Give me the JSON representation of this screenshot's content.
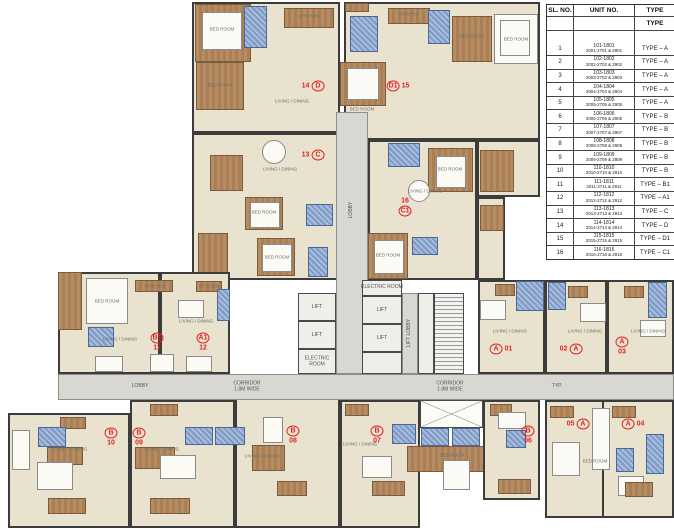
{
  "colors": {
    "wall": "#3c3c3c",
    "room_beige": "#e9e2cf",
    "wood_brown": "#b08158",
    "bath_blue": "#7d9ac7",
    "corridor_gray": "#d9d7d2",
    "unit_label_red": "#e02424"
  },
  "table": {
    "headers": {
      "sl": "SL. NO.",
      "unit": "UNIT NO.",
      "type": "TYPE"
    },
    "subheader_type": "TYPE",
    "rows": [
      {
        "sl": "1",
        "unit1": "101-1801",
        "unit2": "2001-2701 & 2901",
        "type": "TYPE – A"
      },
      {
        "sl": "2",
        "unit1": "102-1802",
        "unit2": "2002-2702 & 2902",
        "type": "TYPE – A"
      },
      {
        "sl": "3",
        "unit1": "103-1803",
        "unit2": "2003-2703 & 2903",
        "type": "TYPE – A"
      },
      {
        "sl": "4",
        "unit1": "104-1804",
        "unit2": "2004-2704 & 2904",
        "type": "TYPE – A"
      },
      {
        "sl": "5",
        "unit1": "105-1805",
        "unit2": "2005-2705 & 2905",
        "type": "TYPE – A"
      },
      {
        "sl": "6",
        "unit1": "106-1806",
        "unit2": "2006-2706 & 2906",
        "type": "TYPE – B"
      },
      {
        "sl": "7",
        "unit1": "107-1807",
        "unit2": "2007-2707 & 2907",
        "type": "TYPE – B"
      },
      {
        "sl": "8",
        "unit1": "108-1808",
        "unit2": "2008-2708 & 2908",
        "type": "TYPE – B"
      },
      {
        "sl": "9",
        "unit1": "109-1809",
        "unit2": "2009-2709 & 2909",
        "type": "TYPE – B"
      },
      {
        "sl": "10",
        "unit1": "110-1810",
        "unit2": "2010-2710 & 2910",
        "type": "TYPE – B"
      },
      {
        "sl": "11",
        "unit1": "111-1811",
        "unit2": "2011-2711 & 2911",
        "type": "TYPE – B1"
      },
      {
        "sl": "12",
        "unit1": "112-1812",
        "unit2": "2012-2712 & 2912",
        "type": "TYPE – A1"
      },
      {
        "sl": "13",
        "unit1": "113-1813",
        "unit2": "2013-2713 & 2913",
        "type": "TYPE – C"
      },
      {
        "sl": "14",
        "unit1": "114-1814",
        "unit2": "2014-2714 & 2914",
        "type": "TYPE – D"
      },
      {
        "sl": "15",
        "unit1": "115-1815",
        "unit2": "2015-2715 & 2915",
        "type": "TYPE – D1"
      },
      {
        "sl": "16",
        "unit1": "116-1816",
        "unit2": "2016-2716 & 2916",
        "type": "TYPE – C1"
      }
    ]
  },
  "plan": {
    "lift_label": "LIFT",
    "unit_labels": [
      {
        "x": 313,
        "y": 86,
        "dir": "row",
        "parts": [
          [
            "14",
            false
          ],
          [
            "D",
            true
          ]
        ]
      },
      {
        "x": 398,
        "y": 86,
        "dir": "row",
        "parts": [
          [
            "D1",
            true
          ],
          [
            "15",
            false
          ]
        ]
      },
      {
        "x": 313,
        "y": 155,
        "dir": "row",
        "parts": [
          [
            "13",
            false
          ],
          [
            "C",
            true
          ]
        ]
      },
      {
        "x": 405,
        "y": 207,
        "dir": "col",
        "parts": [
          [
            "16",
            false
          ],
          [
            "C1",
            true
          ]
        ]
      },
      {
        "x": 157,
        "y": 342,
        "dir": "col",
        "parts": [
          [
            "B1",
            true
          ],
          [
            "11",
            false
          ]
        ]
      },
      {
        "x": 203,
        "y": 342,
        "dir": "col",
        "parts": [
          [
            "A1",
            true
          ],
          [
            "12",
            false
          ]
        ]
      },
      {
        "x": 501,
        "y": 349,
        "dir": "row",
        "parts": [
          [
            "A",
            true
          ],
          [
            "01",
            false
          ]
        ]
      },
      {
        "x": 571,
        "y": 349,
        "dir": "row",
        "parts": [
          [
            "02",
            false
          ],
          [
            "A",
            true
          ]
        ]
      },
      {
        "x": 622,
        "y": 346,
        "dir": "col",
        "parts": [
          [
            "A",
            true
          ],
          [
            "03",
            false
          ]
        ]
      },
      {
        "x": 111,
        "y": 437,
        "dir": "col",
        "parts": [
          [
            "B",
            true
          ],
          [
            "10",
            false
          ]
        ]
      },
      {
        "x": 139,
        "y": 437,
        "dir": "col",
        "parts": [
          [
            "B",
            true
          ],
          [
            "09",
            false
          ]
        ]
      },
      {
        "x": 293,
        "y": 435,
        "dir": "col",
        "parts": [
          [
            "B",
            true
          ],
          [
            "08",
            false
          ]
        ]
      },
      {
        "x": 377,
        "y": 435,
        "dir": "col",
        "parts": [
          [
            "B",
            true
          ],
          [
            "07",
            false
          ]
        ]
      },
      {
        "x": 528,
        "y": 435,
        "dir": "col",
        "parts": [
          [
            "B",
            true
          ],
          [
            "06",
            false
          ]
        ]
      },
      {
        "x": 578,
        "y": 424,
        "dir": "row",
        "parts": [
          [
            "05",
            false
          ],
          [
            "A",
            true
          ]
        ]
      },
      {
        "x": 633,
        "y": 424,
        "dir": "row",
        "parts": [
          [
            "A",
            true
          ],
          [
            "04",
            false
          ]
        ]
      }
    ],
    "text_labels": [
      {
        "x": 140,
        "y": 387,
        "lines": [
          "LOBBY"
        ],
        "rot": false
      },
      {
        "x": 247,
        "y": 387,
        "lines": [
          "CORRIDOR",
          "1.8M WIDE"
        ],
        "rot": false
      },
      {
        "x": 450,
        "y": 387,
        "lines": [
          "CORRIDOR",
          "1.8M WIDE"
        ],
        "rot": false
      },
      {
        "x": 557,
        "y": 387,
        "lines": [
          "TYP."
        ],
        "rot": false
      },
      {
        "x": 382,
        "y": 288,
        "lines": [
          "ELECTRIC ROOM"
        ],
        "rot": false
      },
      {
        "x": 317,
        "y": 362,
        "lines": [
          "ELECTRIC",
          "ROOM"
        ],
        "rot": false
      },
      {
        "x": 410,
        "y": 333,
        "lines": [
          "LIFT LOBBY"
        ],
        "rot": true
      },
      {
        "x": 352,
        "y": 210,
        "lines": [
          "LOBBY"
        ],
        "rot": true
      }
    ],
    "room_labels": [
      {
        "x": 222,
        "y": 30,
        "t": "BED ROOM"
      },
      {
        "x": 309,
        "y": 17,
        "t": "KITCHEN"
      },
      {
        "x": 220,
        "y": 86,
        "t": "BED ROOM"
      },
      {
        "x": 292,
        "y": 102,
        "t": "LIVING / DINING"
      },
      {
        "x": 362,
        "y": 110,
        "t": "BED ROOM"
      },
      {
        "x": 409,
        "y": 15,
        "t": "KITCHEN"
      },
      {
        "x": 472,
        "y": 37,
        "t": "BED ROOM"
      },
      {
        "x": 516,
        "y": 40,
        "t": "BED ROOM"
      },
      {
        "x": 280,
        "y": 170,
        "t": "LIVING / DINING"
      },
      {
        "x": 264,
        "y": 213,
        "t": "BED ROOM"
      },
      {
        "x": 277,
        "y": 258,
        "t": "BED ROOM"
      },
      {
        "x": 450,
        "y": 170,
        "t": "BED ROOM"
      },
      {
        "x": 425,
        "y": 192,
        "t": "LIVING / DINING"
      },
      {
        "x": 388,
        "y": 256,
        "t": "BED ROOM"
      },
      {
        "x": 107,
        "y": 302,
        "t": "BED ROOM"
      },
      {
        "x": 120,
        "y": 340,
        "t": "LIVING / DINING"
      },
      {
        "x": 196,
        "y": 322,
        "t": "LIVING / DINING"
      },
      {
        "x": 510,
        "y": 332,
        "t": "LIVING / DINING"
      },
      {
        "x": 585,
        "y": 332,
        "t": "LIVING / DINING"
      },
      {
        "x": 648,
        "y": 332,
        "t": "LIVING / DINING"
      },
      {
        "x": 155,
        "y": 287,
        "t": "KITCHEN"
      },
      {
        "x": 209,
        "y": 287,
        "t": "KITCHEN"
      },
      {
        "x": 70,
        "y": 450,
        "t": "LIVING / DINING"
      },
      {
        "x": 162,
        "y": 450,
        "t": "LIVING / DINING"
      },
      {
        "x": 262,
        "y": 457,
        "t": "LIVING / DINING"
      },
      {
        "x": 360,
        "y": 445,
        "t": "LIVING / DINING"
      },
      {
        "x": 452,
        "y": 456,
        "t": "BED ROOM"
      },
      {
        "x": 595,
        "y": 462,
        "t": "BED ROOM"
      }
    ]
  }
}
